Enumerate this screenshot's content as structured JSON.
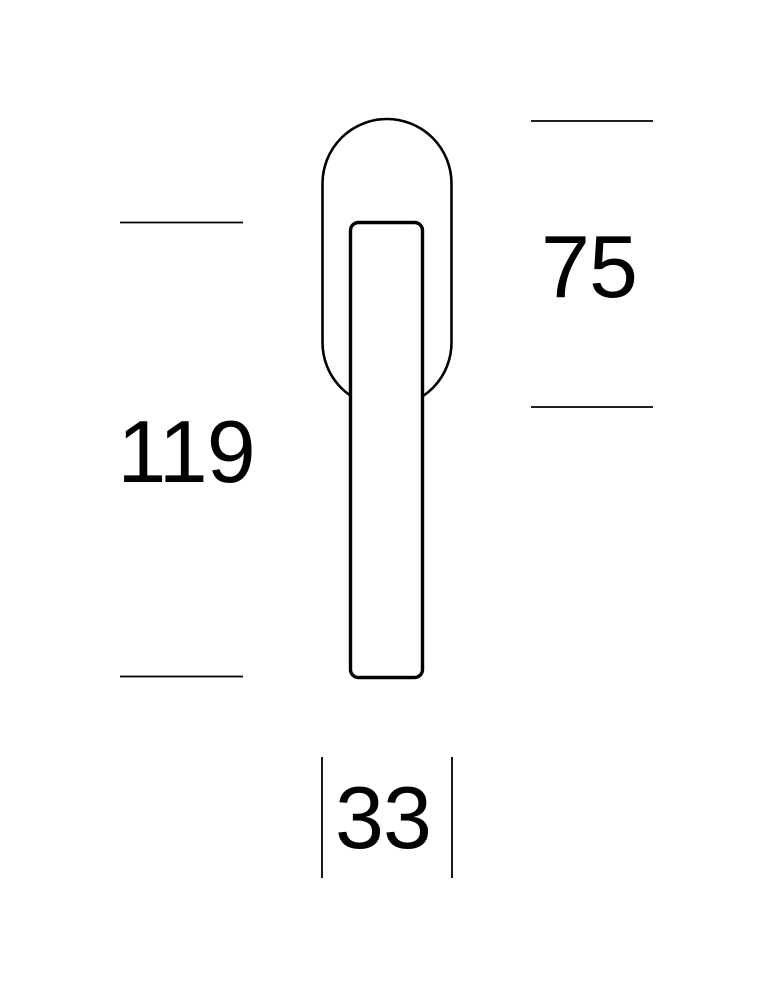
{
  "drawing": {
    "title": "window-handle-technical-drawing",
    "line_color": "#000000",
    "background_color": "#ffffff",
    "dimensions": {
      "lever_length": "119",
      "rosette_height": "75",
      "rosette_width": "33"
    }
  }
}
